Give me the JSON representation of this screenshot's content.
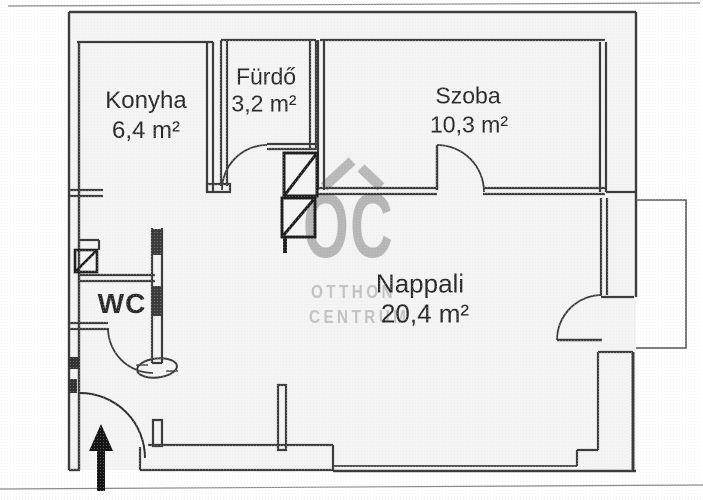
{
  "floor_plan": {
    "rooms": [
      {
        "id": "konyha",
        "name": "Konyha",
        "area": "6,4 m²"
      },
      {
        "id": "furdo",
        "name": "Fürdő",
        "area": "3,2 m²"
      },
      {
        "id": "szoba",
        "name": "Szoba",
        "area": "10,3 m²"
      },
      {
        "id": "nappali",
        "name": "Nappali",
        "area": "20,4 m²"
      },
      {
        "id": "wc",
        "name": "WC",
        "area": ""
      }
    ],
    "watermark": {
      "logo_text": "OC",
      "line1": "OTTHON",
      "line2": "CENTRUM",
      "color": "#b5b5b5"
    },
    "colors": {
      "wall": "#3c3c3c",
      "heavy": "#1f1f1f",
      "text": "#2a2a2a",
      "arrow": "#151515",
      "watermark": "#b5b5b5"
    }
  }
}
